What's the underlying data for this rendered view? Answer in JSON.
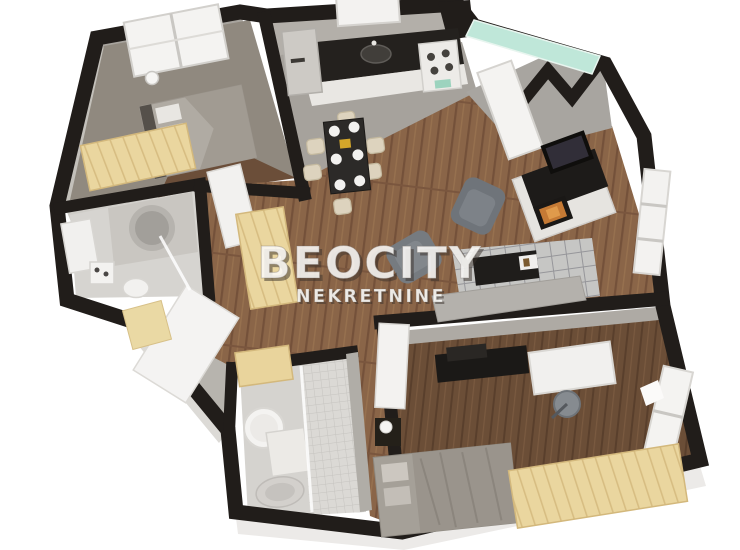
{
  "image": {
    "type": "3d-floor-plan",
    "subject": "bird's-eye 3D render of a two-bedroom apartment"
  },
  "watermark": {
    "title": "BEOCITY",
    "subtitle": "NEKRETNINE"
  },
  "colors": {
    "background": "#ffffff",
    "walls": "#211d1a",
    "wood_floor": "#8a6548",
    "dark_wood_floor": "#6b4e37",
    "tile_floor": "#dbd9d5",
    "kitchen_floor": "#a6a29c",
    "furniture_wood": "#ead69f",
    "counter_top": "#24211e",
    "upholstery_gray": "#7e8387",
    "glass_teal": "#bfe7d9",
    "flame_orange": "#c57a35",
    "watermark_white": "#faf9f7"
  },
  "rooms": [
    "bedroom-1",
    "bathroom-1",
    "kitchen",
    "dining-area",
    "living-area",
    "entrance-hall",
    "bathroom-2",
    "bedroom-2"
  ],
  "furniture": [
    "double-bed",
    "wardrobe",
    "corner-bathtub",
    "washbasin-vanity",
    "toilet",
    "washing-machine",
    "fridge",
    "stove",
    "kitchen-sink",
    "dining-table",
    "dining-chairs",
    "armchair",
    "sofa",
    "coffee-table",
    "rug",
    "fireplace-tv-unit",
    "desk",
    "office-chair",
    "tv-console",
    "nightstand",
    "bedside-lamp",
    "shower",
    "ceiling-lamp"
  ]
}
